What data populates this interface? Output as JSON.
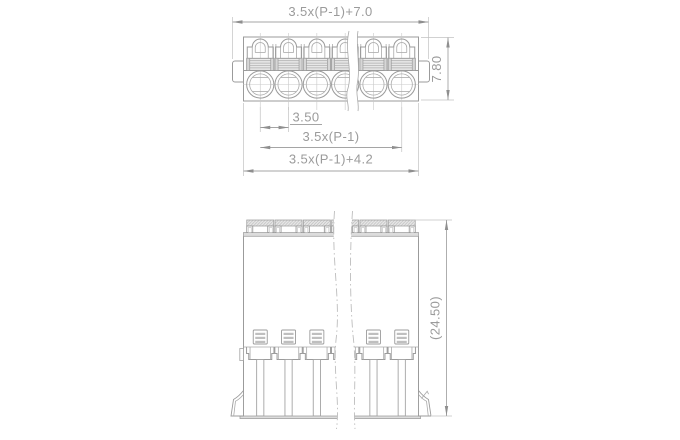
{
  "drawing": {
    "positions_shown": 6,
    "dims": {
      "top_overall": "3.5x(P-1)+7.0",
      "top_height": "7.80",
      "pitch": "3.50",
      "pitch_span": "3.5x(P-1)",
      "body_width": "3.5x(P-1)+4.2",
      "front_height": "(24.50)"
    },
    "colors": {
      "line": "#9b9b9b",
      "dimension": "#a5a5a5",
      "text": "#9b9b9b",
      "background": "#ffffff"
    }
  }
}
